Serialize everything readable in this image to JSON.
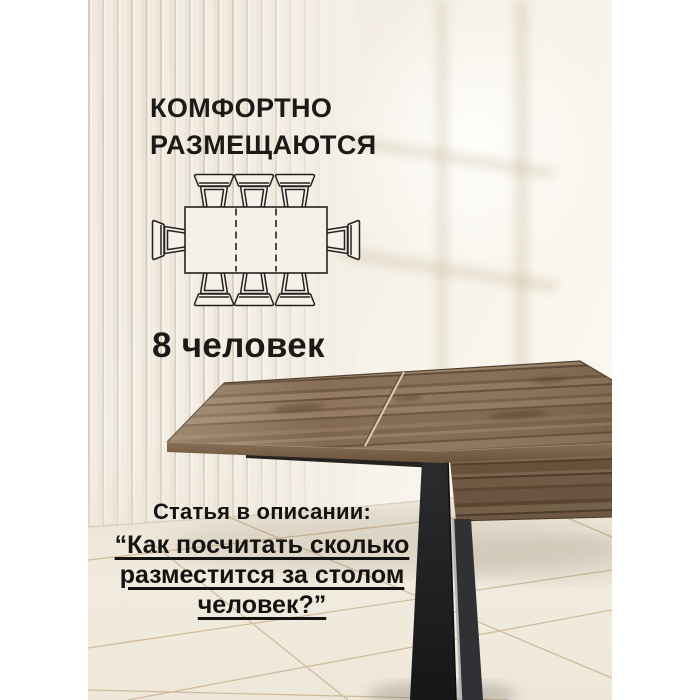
{
  "headline": {
    "line1": "КОМФОРТНО",
    "line2": "РАЗМЕЩАЮТСЯ"
  },
  "capacity": {
    "number": "8",
    "label": "человек"
  },
  "footer": {
    "intro": "Статья в описании:",
    "quote_lines": [
      "“Как посчитать сколько",
      "разместится за столом",
      "человек?”"
    ]
  },
  "diagram": {
    "description": "top view of extendable dining table seating 8 chairs",
    "seats_top": 3,
    "seats_bottom": 3,
    "seats_left": 1,
    "seats_right": 1,
    "extension_marks": "dashed"
  },
  "colors": {
    "text": "#1c1a17",
    "wall_cream": "#f3eee5",
    "wall_bright": "#fdfaf3",
    "flute_shadow": "#c9b391",
    "wood_top": "#8b7157",
    "wood_apron": "#6c5540",
    "metal_leg": "#1f1e21",
    "floor": "#efe8db",
    "tile_grout": "#b8986b",
    "margin": "#ffffff"
  }
}
